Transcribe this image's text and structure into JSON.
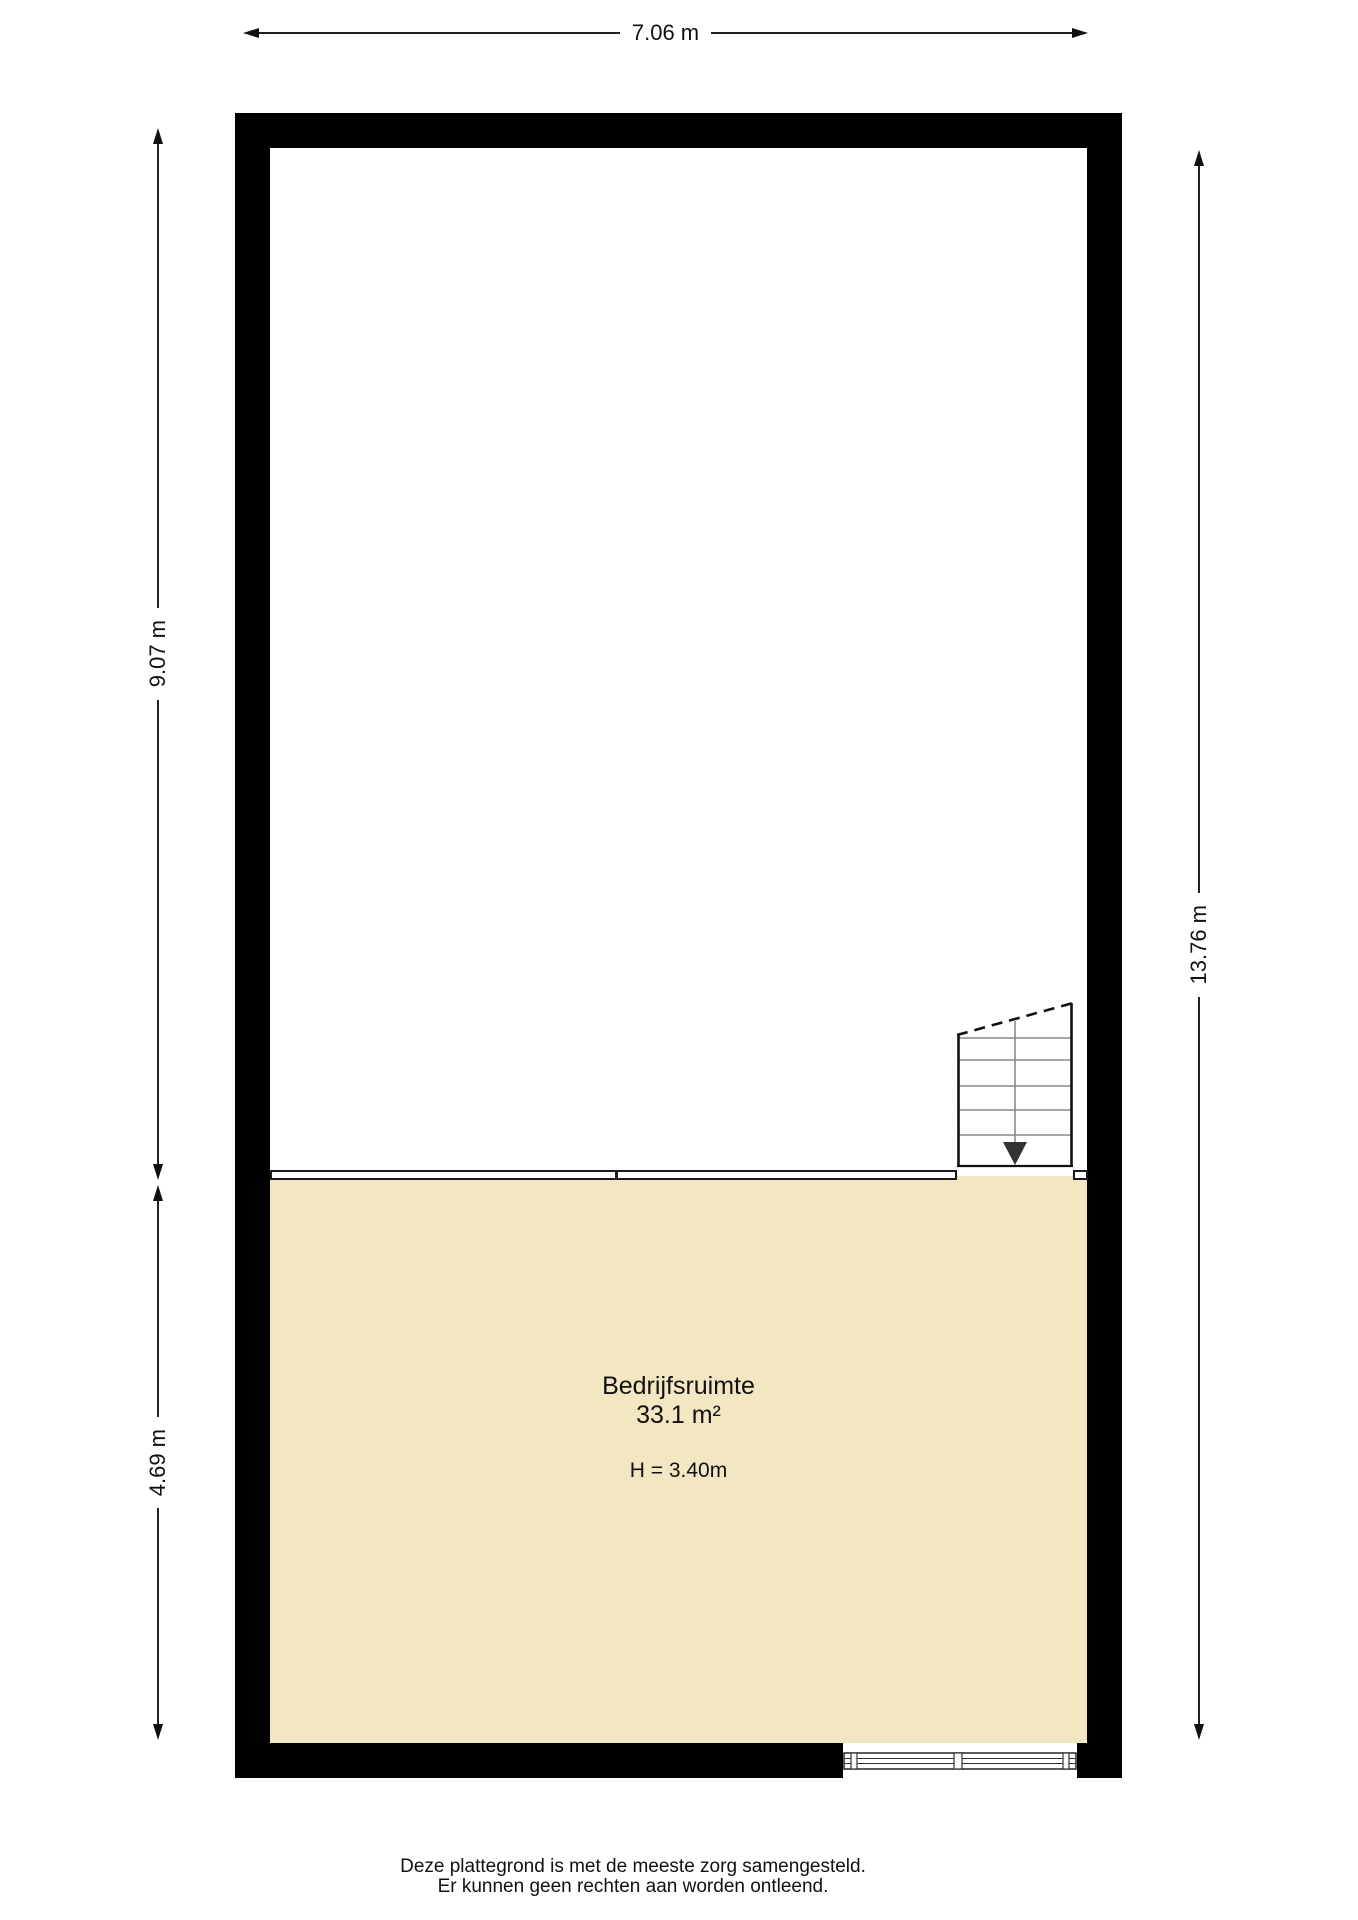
{
  "dimensions": {
    "top": "7.06 m",
    "left_upper": "9.07 m",
    "left_lower": "4.69 m",
    "right": "13.76 m"
  },
  "room": {
    "name": "Bedrijfsruimte",
    "area": "33.1 m²",
    "ceiling_height": "H = 3.40m"
  },
  "footer": {
    "line1": "Deze plattegrond is met de meeste zorg samengesteld.",
    "line2": "Er kunnen geen rechten aan worden ontleend."
  },
  "colors": {
    "wall": "#000000",
    "floor": "#F3E7C3",
    "line": "#1a1a1a",
    "stair_tread": "#8a8a8a",
    "stair_arrow": "#333333"
  }
}
